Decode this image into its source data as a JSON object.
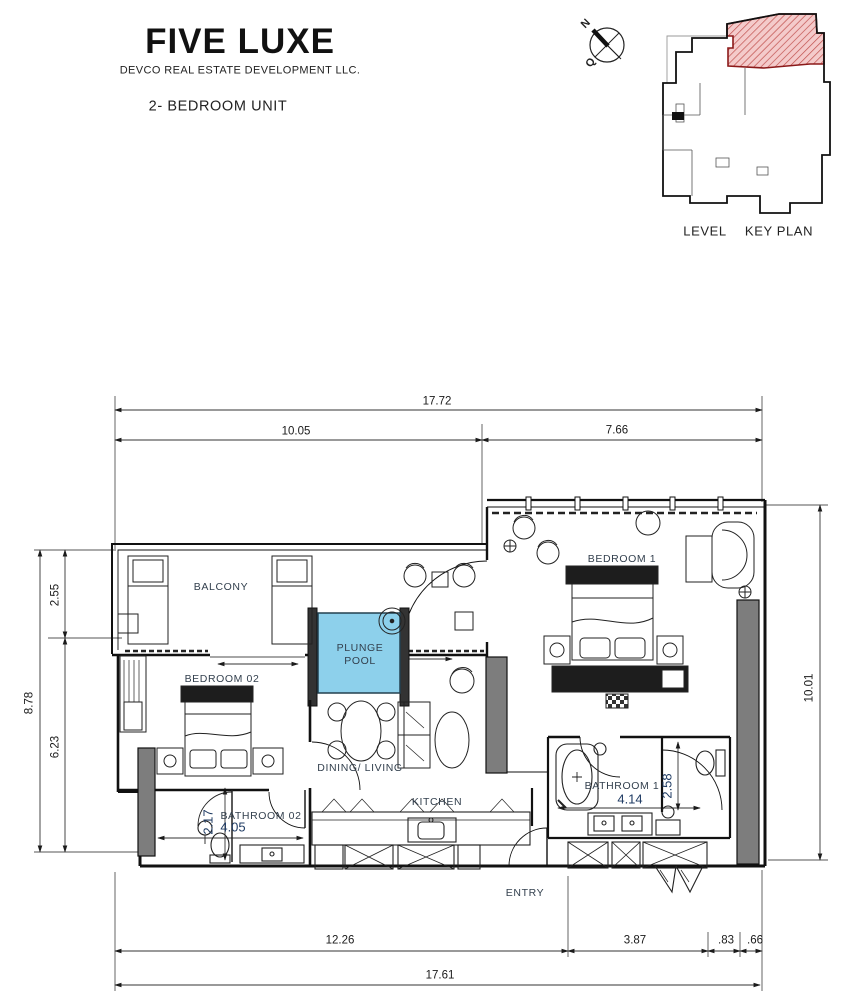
{
  "header": {
    "title": "FIVE LUXE",
    "company": "DEVCO REAL ESTATE DEVELOPMENT LLC.",
    "unit_type": "2- BEDROOM UNIT"
  },
  "compass": {
    "north": "N",
    "secondary": "Q"
  },
  "key_plan": {
    "level_label": "LEVEL",
    "plan_label": "KEY PLAN",
    "highlight_fill": "#F4CBCB",
    "hatch_color": "#C0504D"
  },
  "rooms": {
    "balcony": "BALCONY",
    "bedroom1": "BEDROOM 1",
    "bedroom2": "BEDROOM 02",
    "plunge_pool_line1": "PLUNGE",
    "plunge_pool_line2": "POOL",
    "dining_living": "DINING/ LIVING",
    "kitchen": "KITCHEN",
    "bathroom1": "BATHROOM 1",
    "bathroom2": "BATHROOM 02",
    "entry": "ENTRY"
  },
  "dimensions": {
    "top_total": "17.72",
    "top_left": "10.05",
    "top_right": "7.66",
    "left_total": "8.78",
    "left_upper": "2.55",
    "left_lower": "6.23",
    "right_total": "10.01",
    "bottom_seg1": "12.26",
    "bottom_seg2": "3.87",
    "bottom_seg3": ".83",
    "bottom_seg4": ".66",
    "bottom_total": "17.61",
    "bathroom1_width": "4.14",
    "bathroom1_depth": "2.58",
    "bathroom2_width": "4.05",
    "bathroom2_depth": "2.17"
  },
  "colors": {
    "pool_fill": "#8DD0EB",
    "wall_gray": "#7D7D7D",
    "line": "#1b1b1b",
    "room_label": "#33404E",
    "inner_dim_text": "#1F3B63"
  }
}
